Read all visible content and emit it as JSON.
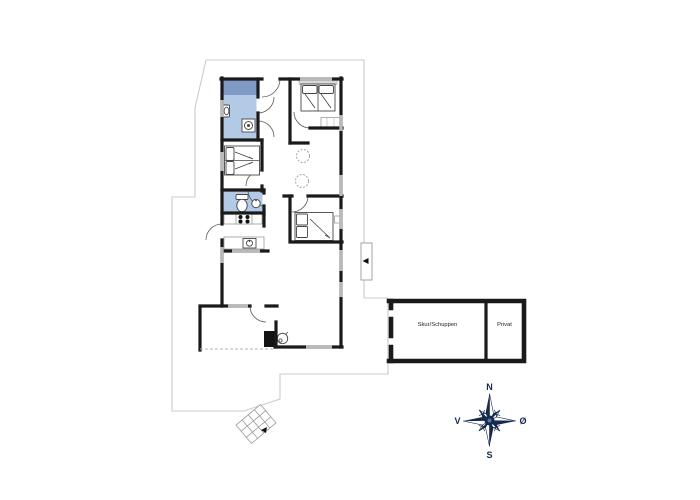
{
  "outbuilding": {
    "shed_label": "Skur/Schuppen",
    "private_label": "Privat"
  },
  "compass": {
    "north": "N",
    "south": "S",
    "west": "V",
    "east": "Ø"
  },
  "colors": {
    "background": "#ffffff",
    "wall": "#1a1a1a",
    "window": "#b9b9b9",
    "bath-floor": "#b3cae7",
    "shower": "#7f9bc5",
    "compass": "#16294d",
    "boundary": "#cbcbcb"
  }
}
